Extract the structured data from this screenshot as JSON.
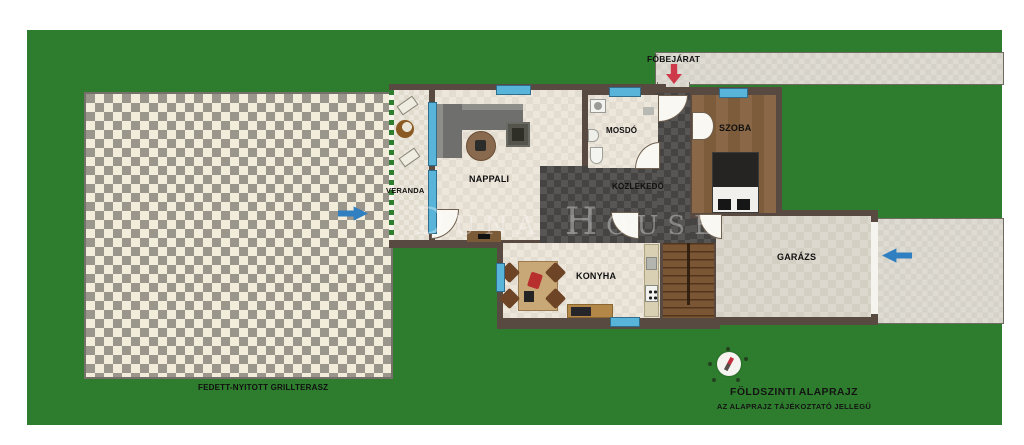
{
  "watermark": "Duna House",
  "labels": {
    "fobejarat": "FŐBEJÁRAT",
    "terrace": "FEDETT-NYITOTT GRILLTERASZ",
    "veranda": "VERANDA",
    "nappali": "NAPPALI",
    "mosdo": "MOSDÓ",
    "kozlekedo": "KÖZLEKEDŐ",
    "szoba": "SZOBA",
    "konyha": "KONYHA",
    "garazs": "GARÁZS"
  },
  "footer": {
    "title": "FÖLDSZINTI ALAPRAJZ",
    "subtitle": "AZ ALAPRAJZ TÁJÉKOZTATÓ JELLEGŰ"
  },
  "icons": {
    "entrance_arrow": "red-down-arrow",
    "terrace_arrow": "blue-right-arrow",
    "garage_arrow": "blue-left-arrow",
    "compass": "compass"
  },
  "colors": {
    "grass": "#2e7d2e",
    "wall": "#594a41",
    "floor_light": "#e9e2d6",
    "hall_dark": "#4c4b49",
    "wood_floor": "#85633f",
    "terrace_base": "#9b968c",
    "terrace_diamond": "#f1edda",
    "paving": "#dad7cf",
    "window": "#58b4d8",
    "arrow_red": "#ce3a49",
    "arrow_blue": "#2f7fc1"
  }
}
